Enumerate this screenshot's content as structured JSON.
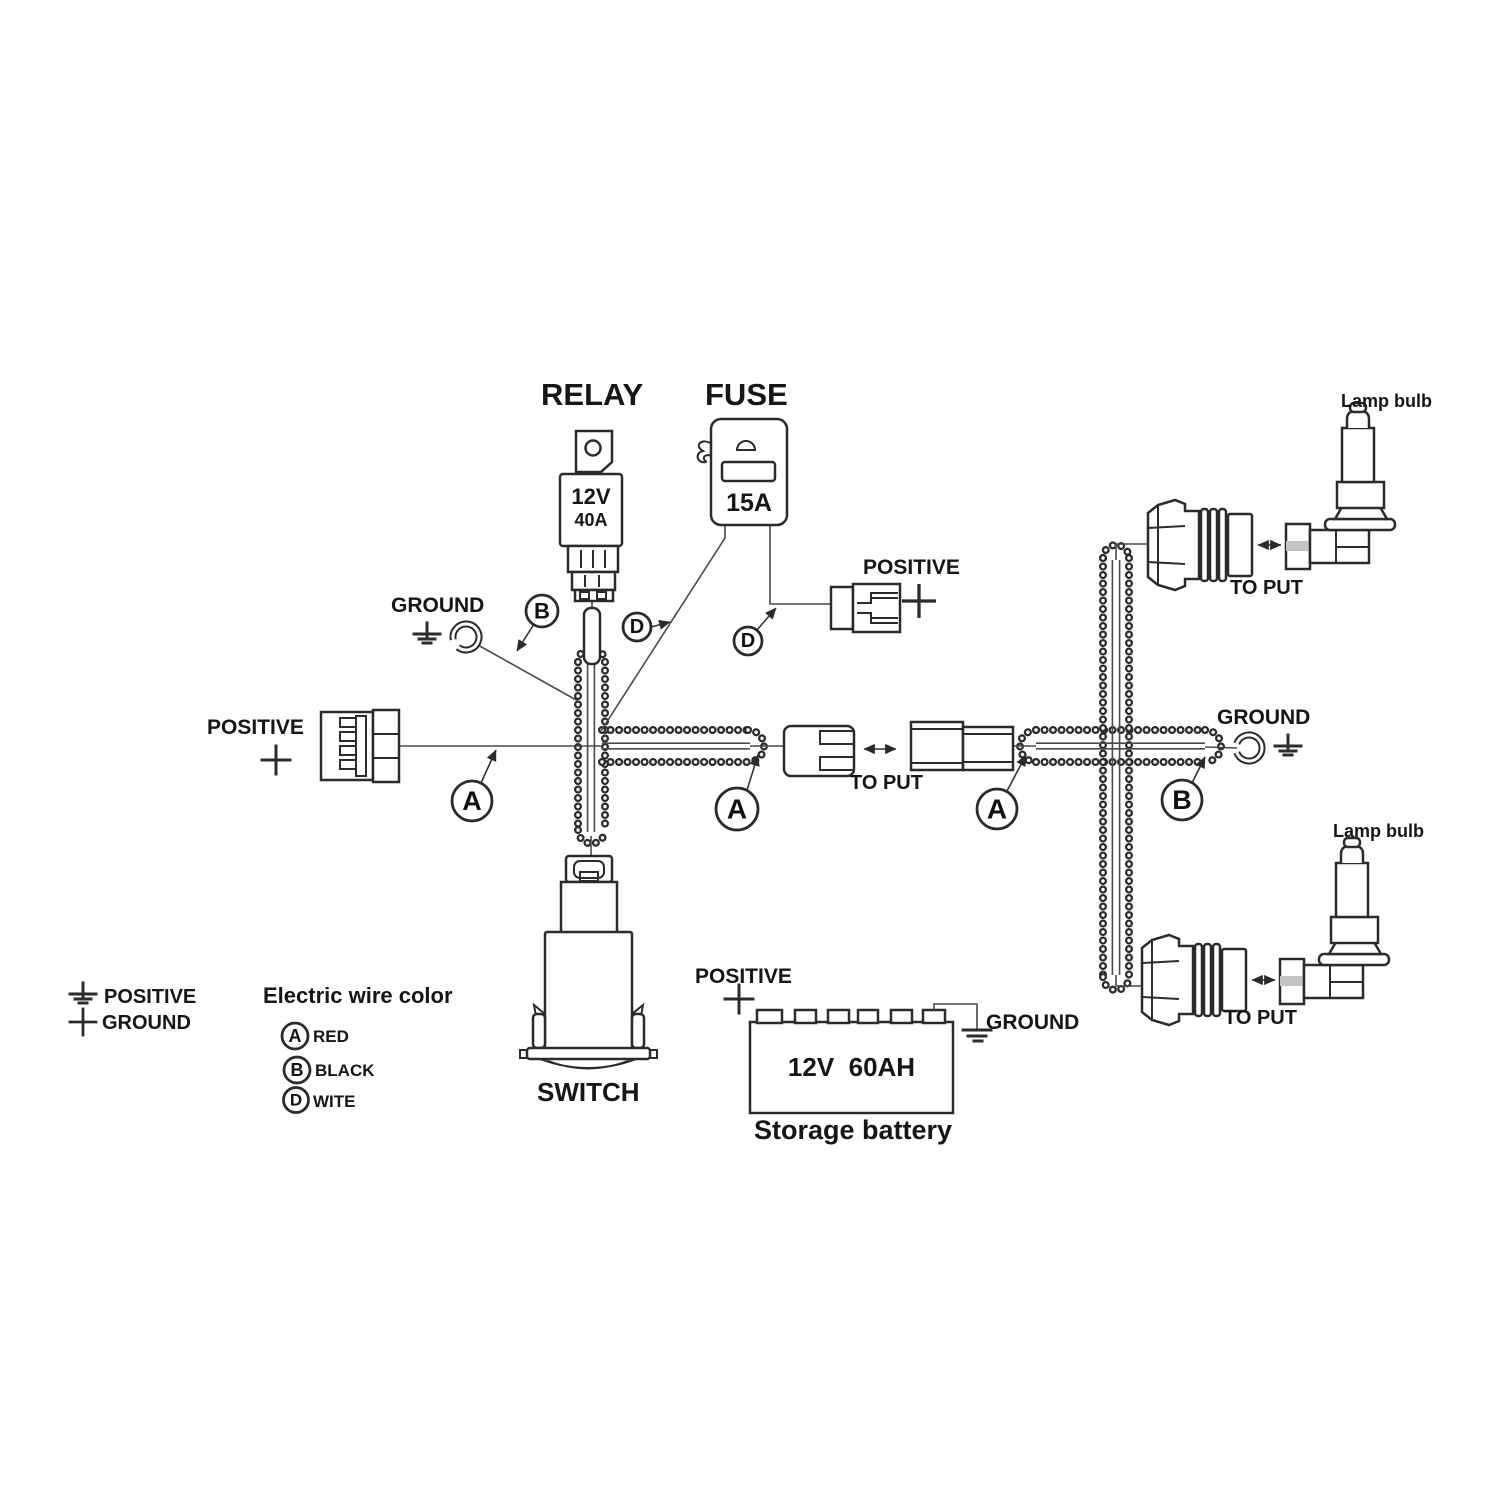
{
  "labels": {
    "relay_title": "RELAY",
    "fuse_title": "FUSE",
    "positive": "POSITIVE",
    "ground": "GROUND",
    "to_put": "TO PUT",
    "lamp_bulb": "Lamp bulb",
    "switch": "SWITCH"
  },
  "relay": {
    "voltage": "12V",
    "current": "40A"
  },
  "fuse": {
    "current": "15A"
  },
  "battery": {
    "rating": "12V  60AH",
    "name": "Storage battery",
    "positive": "POSITIVE",
    "ground": "GROUND"
  },
  "wire_marks": {
    "a": "A",
    "b": "B",
    "d": "D"
  },
  "legend": {
    "positive": "POSITIVE",
    "ground": "GROUND",
    "title": "Electric wire color",
    "items": [
      {
        "mark": "A",
        "color": "RED"
      },
      {
        "mark": "B",
        "color": "BLACK"
      },
      {
        "mark": "D",
        "color": "WITE"
      }
    ]
  },
  "colors": {
    "ink": "#2b2b2b",
    "text": "#161616",
    "background": "#ffffff"
  }
}
